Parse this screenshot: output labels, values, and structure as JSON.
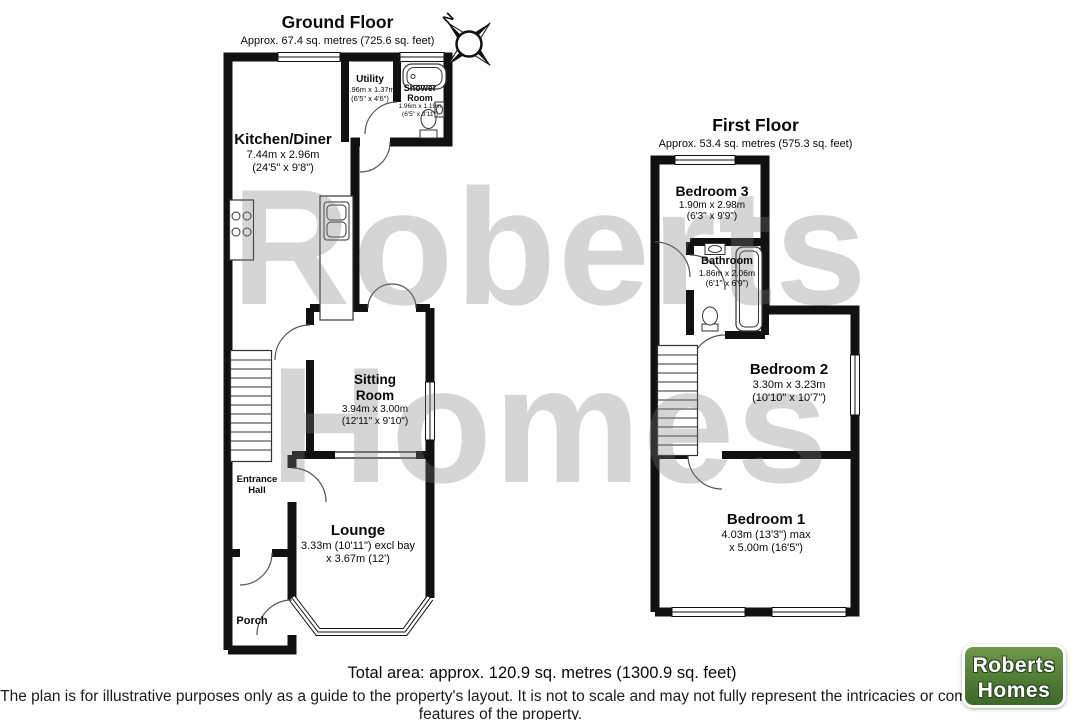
{
  "watermark": {
    "line1": "Roberts",
    "line2": "Homes"
  },
  "compass": {
    "label": "N"
  },
  "colors": {
    "wall": "#111111",
    "fixture_line": "#444444",
    "watermark_gray": "#d2d2d2",
    "logo_green_top": "#71994d",
    "logo_green_bottom": "#3f672a",
    "logo_text": "#ffffff"
  },
  "ground_floor": {
    "title": "Ground Floor",
    "subtitle": "Approx. 67.4 sq. metres (725.6 sq. feet)",
    "rooms": {
      "kitchen": {
        "name": "Kitchen/Diner",
        "dims_m": "7.44m x 2.96m",
        "dims_ft": "(24'5\" x 9'8\")"
      },
      "utility": {
        "name": "Utility",
        "dims_m": "1.96m x 1.37m",
        "dims_ft": "(6'5\" x 4'6\")"
      },
      "shower": {
        "name_line1": "Shower",
        "name_line2": "Room",
        "dims_m": "1.96m x 1.19m",
        "dims_ft": "(6'5\" x 3'11\")"
      },
      "sitting": {
        "name_line1": "Sitting",
        "name_line2": "Room",
        "dims_m": "3.94m x 3.00m",
        "dims_ft": "(12'11\" x 9'10\")"
      },
      "entrance": {
        "name_line1": "Entrance",
        "name_line2": "Hall"
      },
      "lounge": {
        "name": "Lounge",
        "dims_line1": "3.33m (10'11\") excl bay",
        "dims_line2": "x 3.67m (12')"
      },
      "porch": {
        "name": "Porch"
      }
    }
  },
  "first_floor": {
    "title": "First Floor",
    "subtitle": "Approx. 53.4 sq. metres (575.3 sq. feet)",
    "rooms": {
      "bedroom3": {
        "name": "Bedroom 3",
        "dims_m": "1.90m x 2.98m",
        "dims_ft": "(6'3\" x 9'9\")"
      },
      "bathroom": {
        "name": "Bathroom",
        "dims_m": "1.86m x 2.06m",
        "dims_ft": "(6'1\" x 6'9\")"
      },
      "bedroom2": {
        "name": "Bedroom 2",
        "dims_m": "3.30m x 3.23m",
        "dims_ft": "(10'10\" x 10'7\")"
      },
      "bedroom1": {
        "name": "Bedroom 1",
        "dims_line1": "4.03m (13'3\") max",
        "dims_line2": "x 5.00m (16'5\")"
      }
    }
  },
  "footer": {
    "total_area": "Total area: approx. 120.9 sq. metres (1300.9 sq. feet)",
    "disclaimer": "The plan is for illustrative purposes only as a guide to the property's layout. It is not to scale and may not fully represent the intricacies or complete features of the property."
  },
  "logo": {
    "line1": "Roberts",
    "line2": "Homes"
  }
}
